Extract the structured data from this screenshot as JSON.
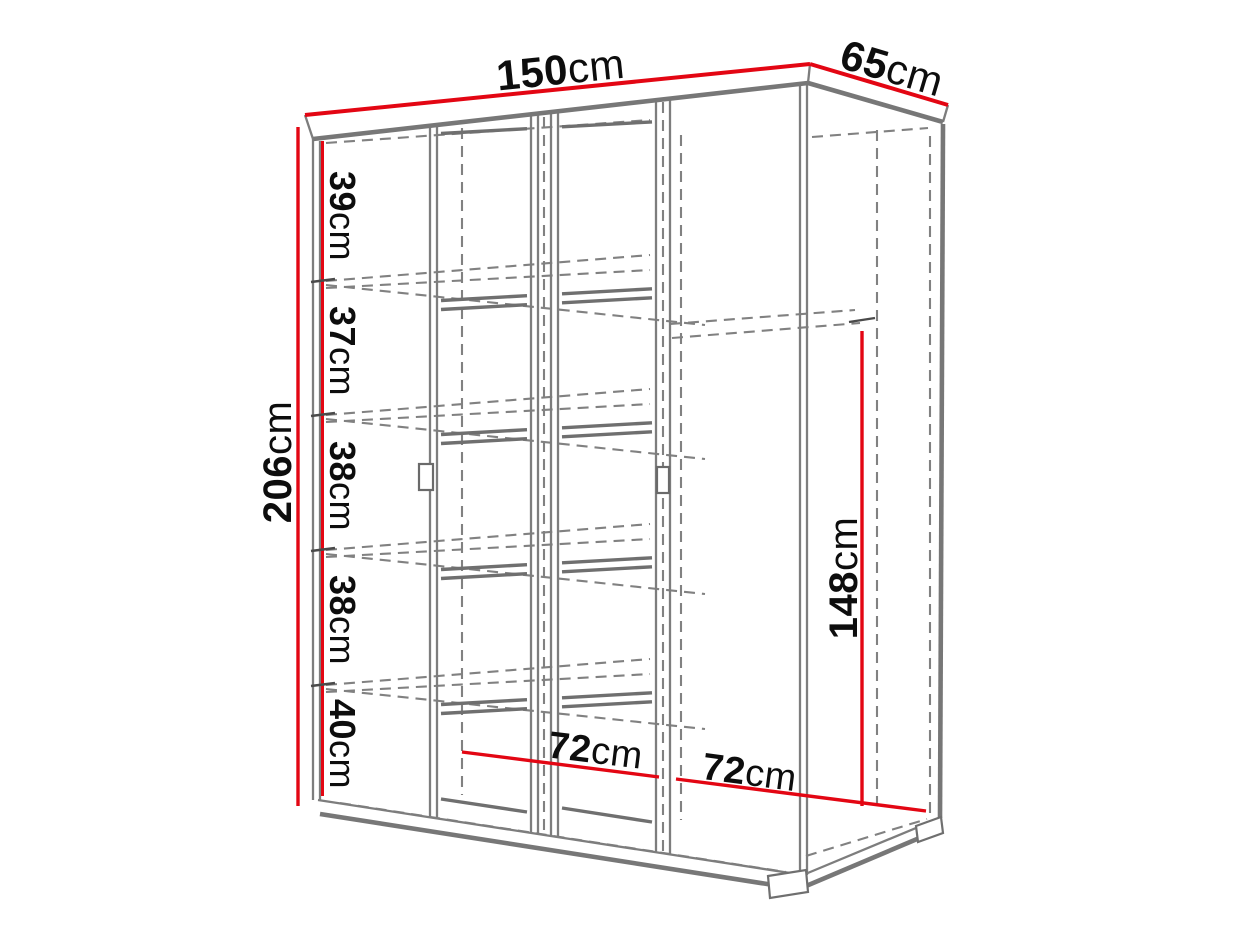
{
  "diagram": {
    "type": "wardrobe-dimension-diagram",
    "width": {
      "value": "150",
      "unit": "cm"
    },
    "depth": {
      "value": "65",
      "unit": "cm"
    },
    "height": {
      "value": "206",
      "unit": "cm"
    },
    "hang_height": {
      "value": "148",
      "unit": "cm"
    },
    "section_widths": [
      {
        "value": "72",
        "unit": "cm"
      },
      {
        "value": "72",
        "unit": "cm"
      }
    ],
    "shelf_gaps": [
      {
        "value": "39",
        "unit": "cm"
      },
      {
        "value": "37",
        "unit": "cm"
      },
      {
        "value": "38",
        "unit": "cm"
      },
      {
        "value": "38",
        "unit": "cm"
      },
      {
        "value": "40",
        "unit": "cm"
      }
    ]
  },
  "colors": {
    "dimension": "#e30613",
    "outline": "#7b7b7b",
    "label": "#0d0d0d",
    "background": "#ffffff"
  }
}
